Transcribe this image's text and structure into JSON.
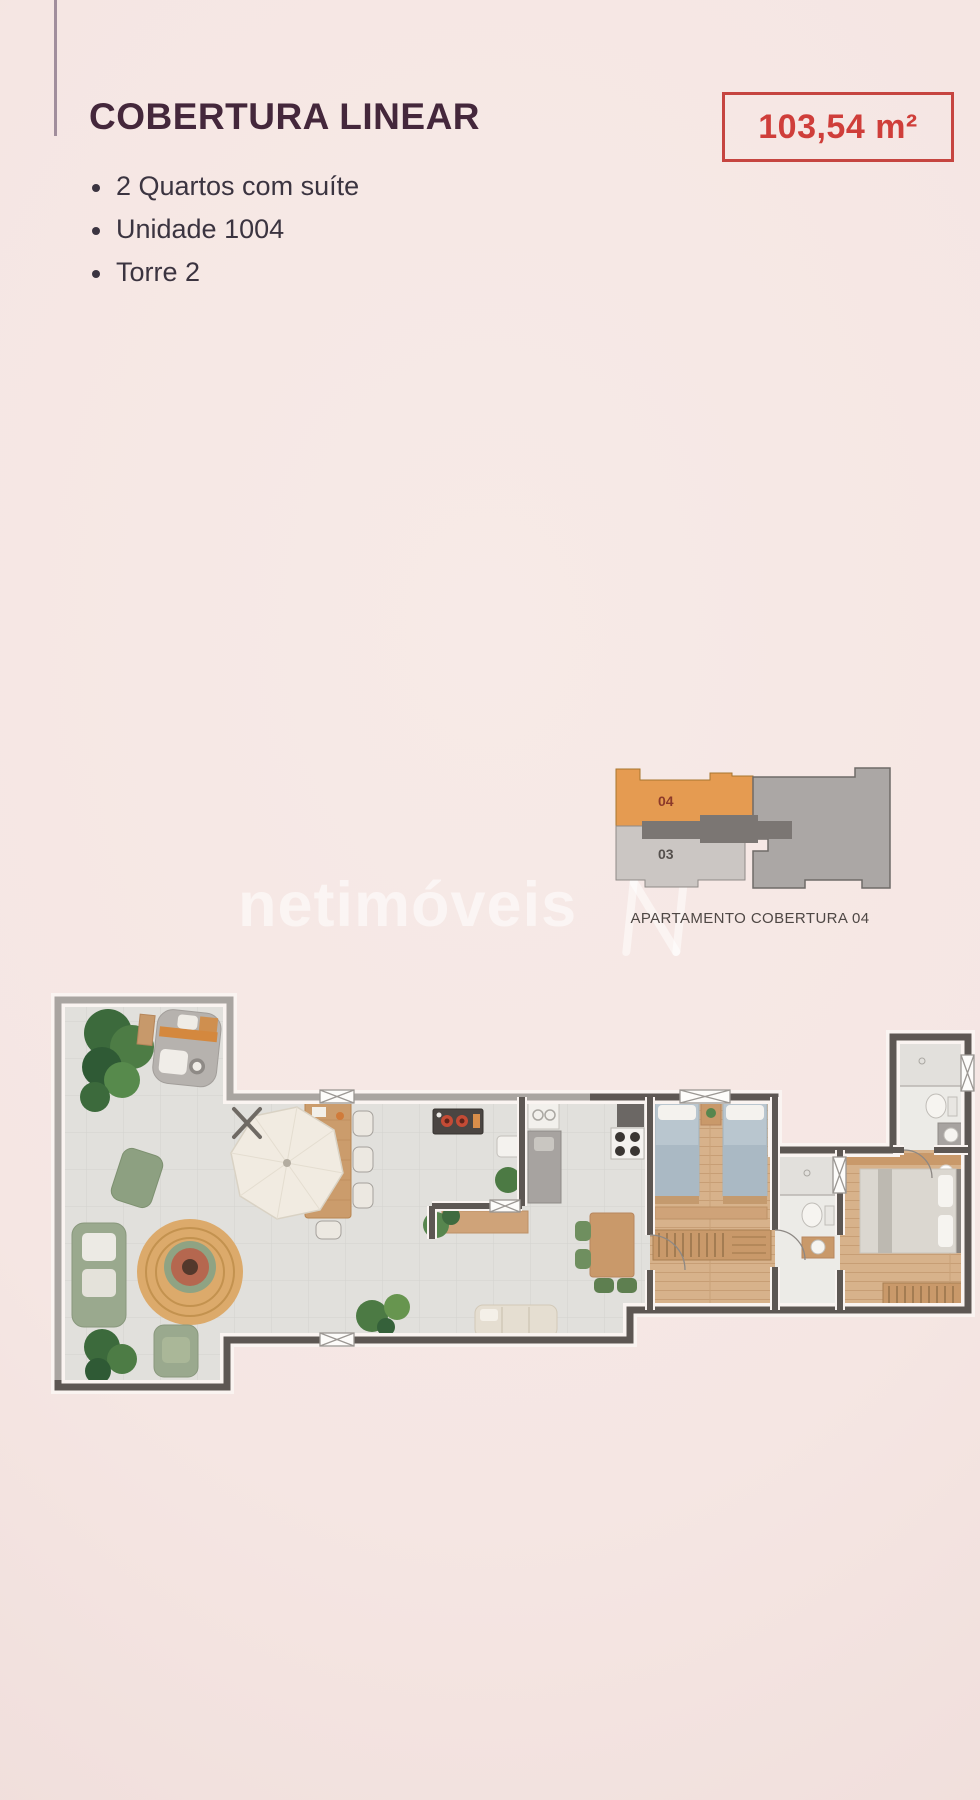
{
  "page": {
    "background_color": "#f5e6e3",
    "vignette_color": "#eedbd8",
    "accent_line_color": "#a18e9c"
  },
  "header": {
    "title": "COBERTURA LINEAR",
    "title_color": "#44273b",
    "area_badge": {
      "text": "103,54 m²",
      "color": "#cf3e3a",
      "border_color": "#c64540"
    },
    "features": [
      "2 Quartos com suíte",
      "Unidade 1004",
      "Torre 2"
    ],
    "features_color": "#3b3440"
  },
  "watermark": {
    "text": "netimóveis",
    "logo_icon": "netimoveis-n-mark",
    "color": "rgba(255,255,255,0.55)"
  },
  "locator": {
    "caption": "APARTAMENTO COBERTURA 04",
    "caption_color": "#4e4744",
    "unit_primary": {
      "label": "04",
      "fill": "#e59b51",
      "label_color": "#8c3a2a"
    },
    "unit_secondary": {
      "label": "03",
      "fill": "#cbc6c3",
      "label_color": "#55504d"
    },
    "neighbor_tower_fill": "#aba7a5",
    "corridor_fill": "#7b7673"
  },
  "floor_plan": {
    "type": "apartment-floor-plan-top-view",
    "wall_color": "#5d5753",
    "wall_trim_color": "#faf4f1",
    "tile_floor_color": "#e1e0dc",
    "wood_floor_color": "#d7b28b",
    "bath_floor_color": "#ecebe7",
    "rooms": [
      "terraço gourmet",
      "cozinha",
      "sala",
      "quarto",
      "banheiro",
      "suíte",
      "banheiro suíte"
    ]
  }
}
